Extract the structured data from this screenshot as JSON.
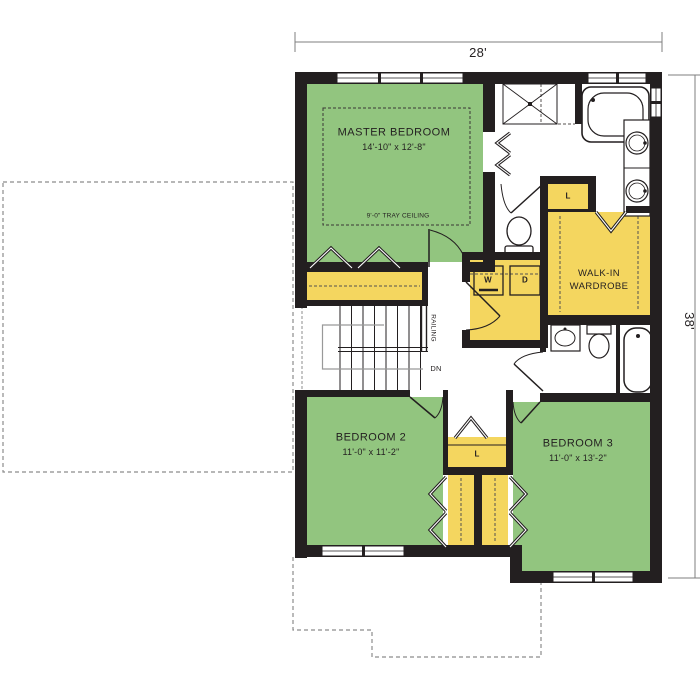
{
  "dimensions": {
    "width_label": "28'",
    "depth_label": "38'"
  },
  "rooms": {
    "master_bedroom": {
      "name": "MASTER BEDROOM",
      "size": "14'-10\" x 12'-8\"",
      "ceiling_note": "9'-0\" TRAY CEILING"
    },
    "bedroom_2": {
      "name": "BEDROOM 2",
      "size": "11'-0\" x 11'-2\""
    },
    "bedroom_3": {
      "name": "BEDROOM 3",
      "size": "11'-0\" x 13'-2\""
    },
    "walk_in_wardrobe": {
      "name": "WALK-IN WARDROBE"
    },
    "laundry": {
      "washer_label": "W",
      "dryer_label": "D"
    },
    "linen_closet_hall": {
      "label": "L"
    },
    "linen_closet_bedrooms": {
      "label": "L"
    },
    "stairs": {
      "down_label": "DN",
      "railing_label": "RAILING"
    }
  },
  "colors": {
    "bedroom_fill": "#92c57f",
    "closet_fill": "#f4d65f",
    "wall": "#231f20",
    "dash_gray": "#8c8c8c",
    "dim_gray": "#7f7f7f"
  }
}
